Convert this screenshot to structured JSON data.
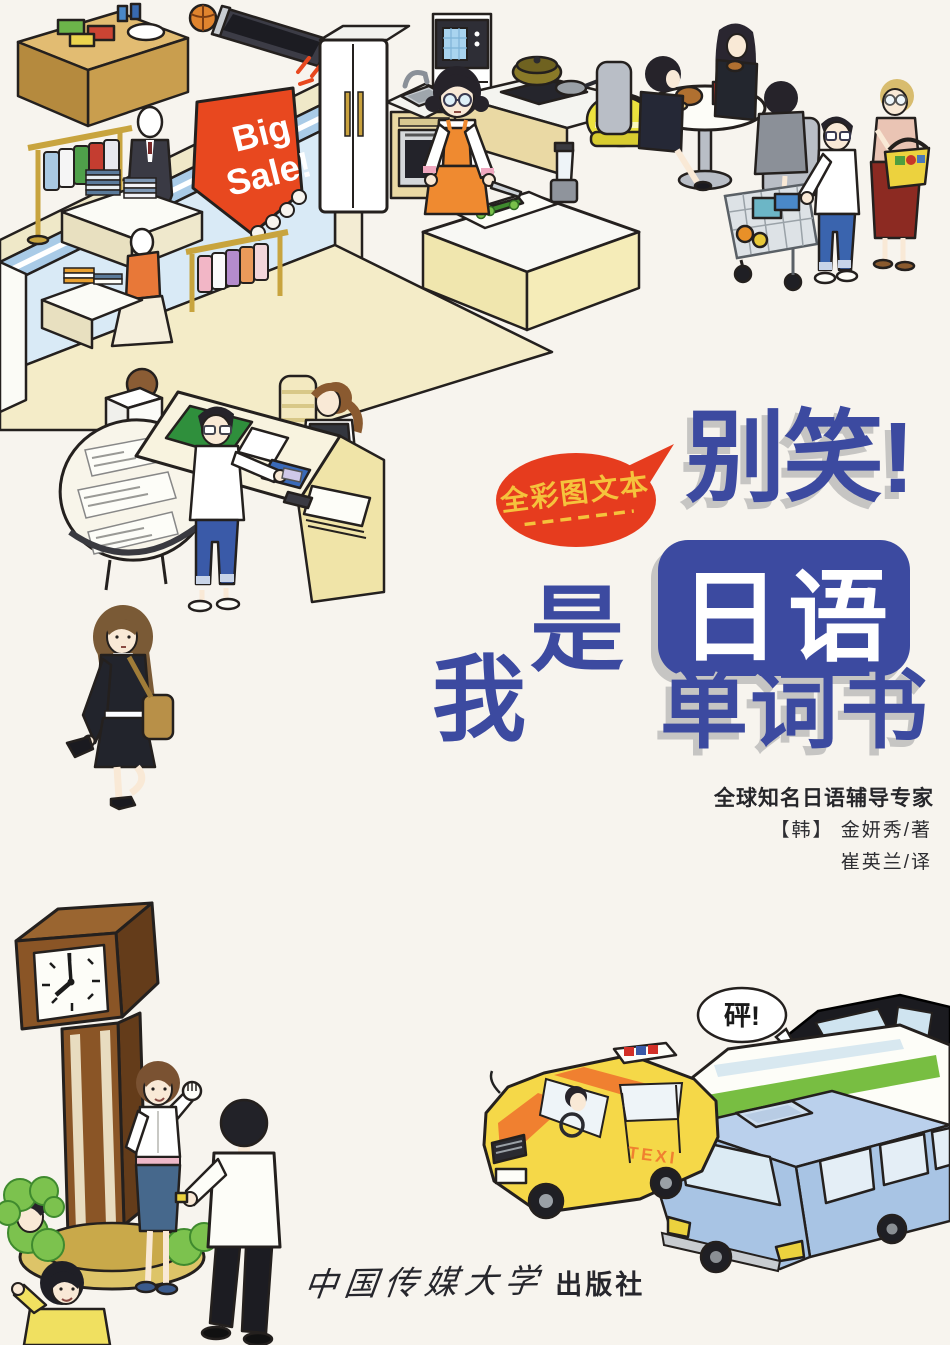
{
  "cover": {
    "badge_text": "全彩图文本",
    "title_top": "别笑!",
    "title_mid": "日语",
    "title_bottom": "单词书",
    "char_wo": "我",
    "char_shi": "是",
    "tagline": "全球知名日语辅导专家",
    "author": "【韩】 金妍秀/著",
    "translator": "崔英兰/译",
    "publisher_script": "中国传媒大学",
    "publisher_suffix": "出版社"
  },
  "art": {
    "sale_line1": "Big",
    "sale_line2": "Sale!",
    "crash_text": "砰!",
    "taxi_text": "TEXI"
  },
  "colors": {
    "title_blue": "#3c4aa0",
    "title_shadow": "#c6c5c3",
    "badge_red": "#e63c1e",
    "badge_yellow": "#f5c33c",
    "sale_sign_red": "#e8481f",
    "taxi_yellow": "#f5d848",
    "taxi_stripe_orange": "#f08030",
    "van_blue": "#a8c4e4",
    "bus_stripe_green": "#78be42",
    "background": "#f7f4ee"
  }
}
